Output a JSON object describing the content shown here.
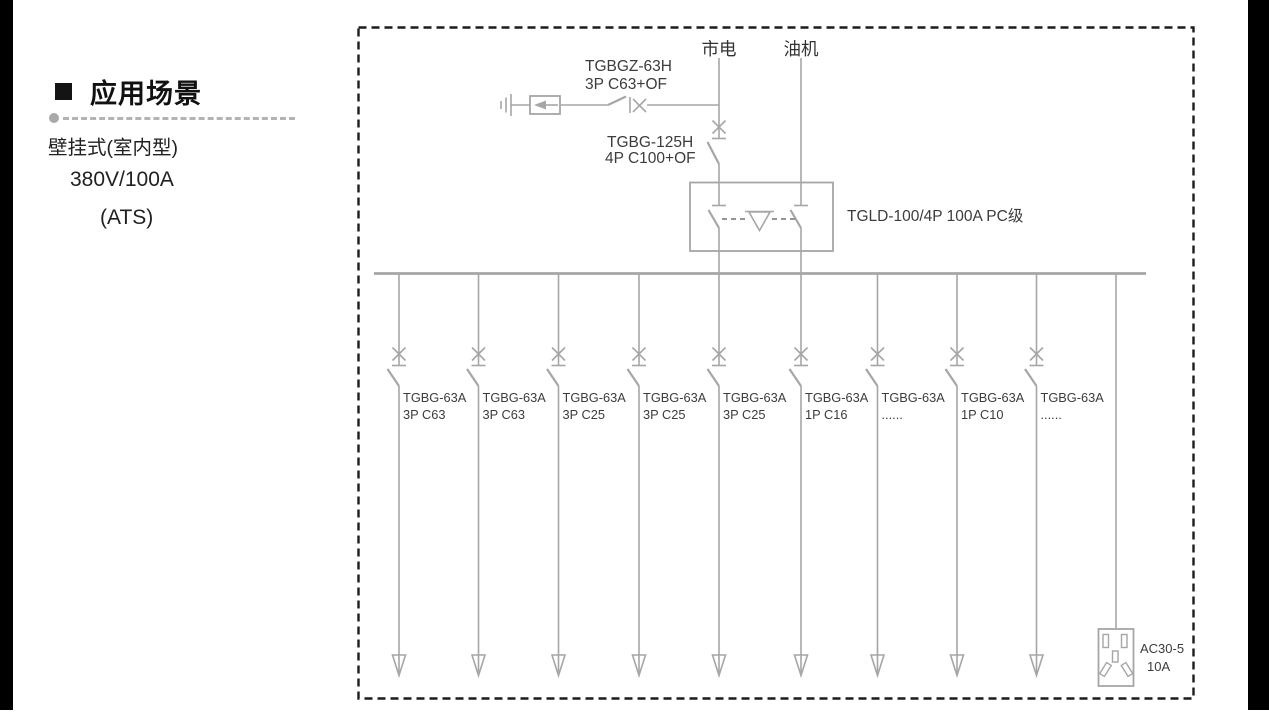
{
  "colors": {
    "wire": "#a6a6a6",
    "diagram_text": "#3c3c3c",
    "dashed_border": "#1c1c1c",
    "sidebar_text": "#212121",
    "edge_bars": "#000000"
  },
  "sidebar": {
    "title": "应用场景",
    "lines": [
      "壁挂式(室内型)",
      "380V/100A",
      "(ATS)"
    ]
  },
  "diagram": {
    "sources": {
      "mains": "市电",
      "generator": "油机"
    },
    "spd_breaker": {
      "model": "TGBGZ-63H",
      "spec": "3P C63+OF"
    },
    "main_breaker": {
      "model": "TGBG-125H",
      "spec": "4P C100+OF"
    },
    "ats": {
      "label": "TGLD-100/4P 100A PC级"
    },
    "branches": [
      {
        "model": "TGBG-63A",
        "spec": "3P C63"
      },
      {
        "model": "TGBG-63A",
        "spec": "3P C63"
      },
      {
        "model": "TGBG-63A",
        "spec": "3P C25"
      },
      {
        "model": "TGBG-63A",
        "spec": "3P C25"
      },
      {
        "model": "TGBG-63A",
        "spec": "3P C25"
      },
      {
        "model": "TGBG-63A",
        "spec": "1P C16"
      },
      {
        "model": "TGBG-63A",
        "spec": "......"
      },
      {
        "model": "TGBG-63A",
        "spec": "1P C10"
      },
      {
        "model": "TGBG-63A",
        "spec": "......"
      }
    ],
    "socket": {
      "model": "AC30-5",
      "rating": "10A"
    }
  }
}
